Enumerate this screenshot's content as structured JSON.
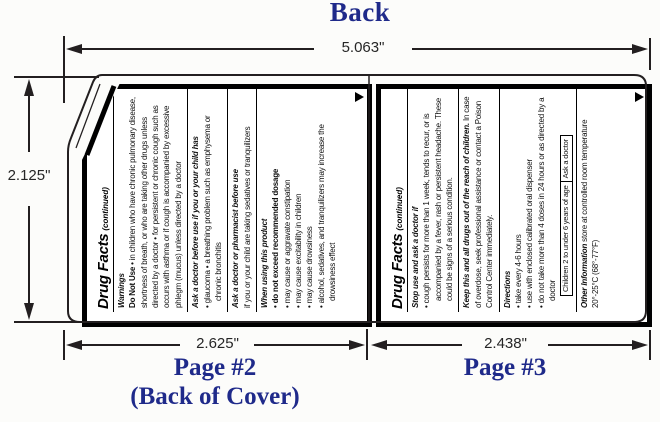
{
  "header": {
    "title": "Back"
  },
  "dimensions": {
    "total_width": "5.063\"",
    "height": "2.125\"",
    "page2_width": "2.625\"",
    "page3_width": "2.438\""
  },
  "footer": {
    "page2_label": "Page #2",
    "page2_sublabel": "(Back of Cover)",
    "page3_label": "Page #3"
  },
  "colors": {
    "accent_navy": "#1f2a8a",
    "line": "#231f20",
    "panel_border": "#000000",
    "background": "#fcfcfa"
  },
  "icons": {
    "continued_arrow": "right-triangle-icon"
  },
  "panel2": {
    "drug_facts": "Drug Facts",
    "continued": "(continued)",
    "warnings": {
      "heading": "Warnings",
      "lead": "Do Not Use",
      "body": " • in children who have chronic pulmonary disease, shortness of breath, or who are taking other drugs unless directed by a doctor • for persistent or chronic cough such as occurs with asthma or if cough is accompanied by excessive phlegm (mucus) unless directed by a doctor"
    },
    "ask_doctor": {
      "heading": "Ask a doctor before use if you or your child has",
      "body": "• glaucoma • a breathing problem such as emphysema or chronic bronchitis"
    },
    "ask_pharmacist": {
      "heading": "Ask a doctor or pharmacist before use",
      "body": "if you or your child are taking sedatives or tranquilizers"
    },
    "when_using": {
      "heading": "When using this product",
      "bullets": [
        "• do not exceed recommended dosage",
        "• may cause or aggravate constipation",
        "• may cause excitability in children",
        "• may cause drowsiness",
        "• alcohol, sedatives, and tranquilizers may increase the drowsiness effect"
      ]
    }
  },
  "panel3": {
    "drug_facts": "Drug Facts",
    "continued": "(continued)",
    "stop_use": {
      "heading": "Stop use and ask a doctor if",
      "body": "• cough persists for more than 1 week, tends to recur, or is accompanied by a fever, rash or persistent headache. These could be signs of a serious condition."
    },
    "keep_out": {
      "heading": "Keep this and all drugs out of the reach of children.",
      "body": " In case of overdose, seek professional assistance or contact a Poison Control Center immediately."
    },
    "directions": {
      "heading": "Directions",
      "bullets": [
        "• take every 4-6 hours",
        "• use with enclosed calibrated oral dispenser",
        "• do not take more than 4 doses in 24 hours or as directed by a doctor"
      ],
      "table": {
        "col1": "Children 2 to under 6 years of age",
        "col2": "Ask a doctor"
      }
    },
    "other_info": {
      "heading": "Other Information",
      "body": " store at controlled room temperature 20°-25°C (68°-77°F)"
    }
  }
}
